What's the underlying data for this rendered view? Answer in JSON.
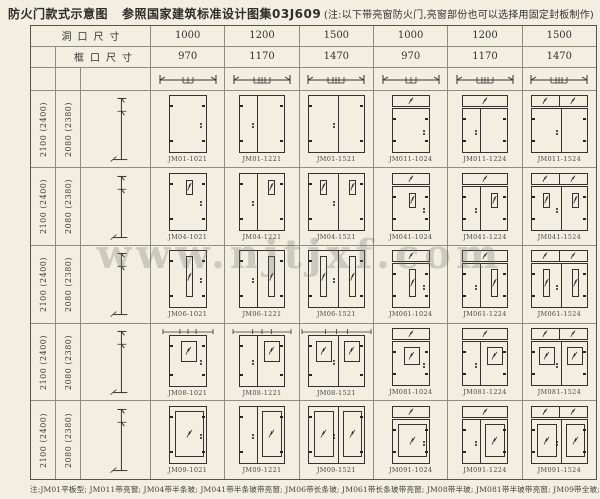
{
  "title": {
    "main": "防火门款式示意图",
    "ref": "参照国家建筑标准设计图集03J609",
    "note": "(注:以下带亮窗防火门,亮窗部份也可以选择用固定封板制作)"
  },
  "watermark": "www.njtjxf.com",
  "header": {
    "hole_label": "洞口尺寸",
    "hole_sizes": [
      "1000",
      "1200",
      "1500",
      "1000",
      "1200",
      "1500"
    ],
    "frame_label": "框口尺寸",
    "frame_sizes": [
      "970",
      "1170",
      "1470",
      "970",
      "1170",
      "1470"
    ]
  },
  "row_heights": {
    "hole": "2100 (2400)",
    "frame": "2080 (2380)"
  },
  "columns": [
    {
      "size": "1000",
      "leaves": 1,
      "unequal": false,
      "transom": 0
    },
    {
      "size": "1200",
      "leaves": 2,
      "unequal": true,
      "transom": 0
    },
    {
      "size": "1500",
      "leaves": 2,
      "unequal": false,
      "transom": 0
    },
    {
      "size": "1000",
      "leaves": 1,
      "unequal": false,
      "transom": 1
    },
    {
      "size": "1200",
      "leaves": 2,
      "unequal": true,
      "transom": 1
    },
    {
      "size": "1500",
      "leaves": 2,
      "unequal": false,
      "transom": 2
    }
  ],
  "rows": [
    {
      "series": "JM01",
      "style": "平板型",
      "glass": "none",
      "labels": [
        "JM01-1021",
        "JM01-1221",
        "JM01-1521",
        "JM011-1024",
        "JM011-1224",
        "JM011-1524"
      ]
    },
    {
      "series": "JM04",
      "style": "带半条玻",
      "glass": "half-strip",
      "labels": [
        "JM04-1021",
        "JM04-1221",
        "JM04-1521",
        "JM041-1024",
        "JM041-1224",
        "JM041-1524"
      ]
    },
    {
      "series": "JM06",
      "style": "带长条玻",
      "glass": "long-strip",
      "labels": [
        "JM06-1021",
        "JM06-1221",
        "JM06-1521",
        "JM061-1024",
        "JM061-1224",
        "JM061-1524"
      ]
    },
    {
      "series": "JM08",
      "style": "带半玻",
      "glass": "half-glass",
      "labels": [
        "JM08-1021",
        "JM08-1221",
        "JM08-1521",
        "JM081-1024",
        "JM081-1224",
        "JM081-1524"
      ]
    },
    {
      "series": "JM09",
      "style": "带全玻",
      "glass": "full-glass",
      "labels": [
        "JM09-1021",
        "JM09-1221",
        "JM09-1521",
        "JM091-1024",
        "JM091-1224",
        "JM091-1524"
      ]
    }
  ],
  "footnote": "注:JM01平板型; JM011带亮窗; JM04带半条玻; JM041带半条玻带亮窗; JM06带长条玻; JM061带长条玻带亮窗; JM08带半玻; JM081带半玻带亮窗; JM09带全玻; JM091带全玻带亮窗;",
  "colors": {
    "background": "#f2efe2",
    "line": "#34322b",
    "grid": "#8f8d80",
    "text": "#3b3a33",
    "watermark_gray": "#77766e"
  }
}
